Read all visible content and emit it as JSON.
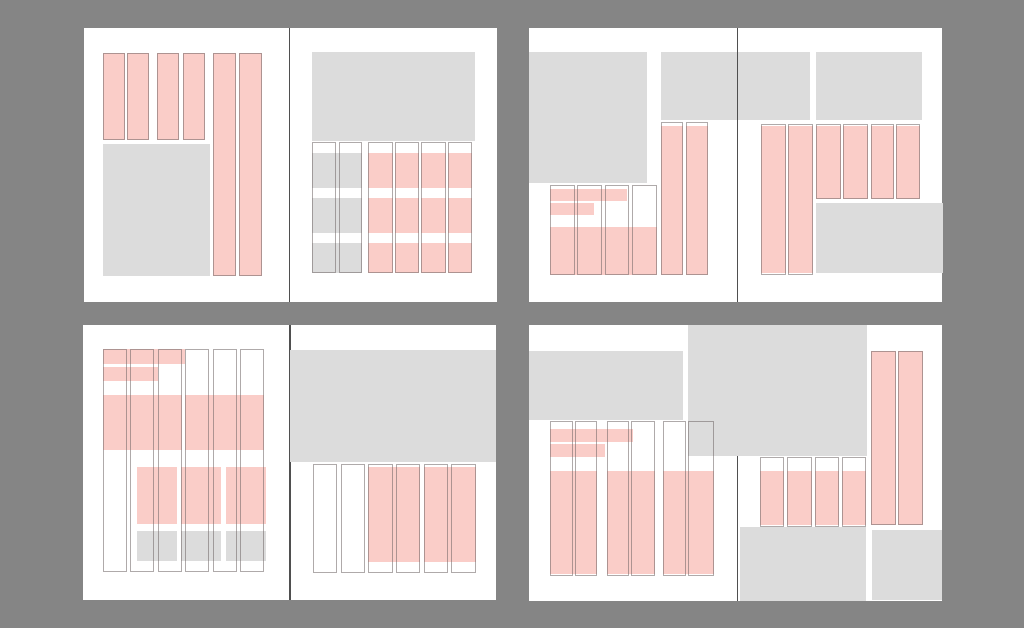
{
  "canvas": {
    "width": 1024,
    "height": 628,
    "background": "#858585"
  },
  "colors": {
    "page_white": "#ffffff",
    "block_gray": "#dcdcdc",
    "block_pink": "#facdc8",
    "outline": "rgba(110,100,100,0.55)",
    "spine": "#4f4f4f"
  },
  "legend": {
    "gray_block_meaning": "image-placeholder-block",
    "pink_block_meaning": "text-content-block",
    "outline_meaning": "column-outline"
  },
  "spreads": [
    {
      "name": "spread-top-left",
      "x": 84,
      "y": 28,
      "w": 412.5,
      "h": 273.5,
      "spine_x": 288.8,
      "spine_over": true,
      "blocks": [
        [
          "g",
          102.5,
          143.5,
          107.5,
          132.5
        ],
        [
          "g",
          312.3,
          52.0,
          162.5,
          89.0
        ],
        [
          "g",
          312.3,
          153.3,
          50.0,
          35.0
        ],
        [
          "g",
          312.3,
          198.3,
          50.0,
          35.0
        ],
        [
          "g",
          312.3,
          243.3,
          50.0,
          30.0
        ],
        [
          "p",
          102.5,
          52.7,
          22.0,
          87.0
        ],
        [
          "p",
          127.0,
          52.7,
          22.0,
          87.0
        ],
        [
          "p",
          156.5,
          52.7,
          22.0,
          87.0
        ],
        [
          "p",
          183.0,
          52.7,
          22.0,
          87.0
        ],
        [
          "p",
          213.0,
          52.7,
          23.0,
          223.3
        ],
        [
          "p",
          239.0,
          52.7,
          23.0,
          223.3
        ],
        [
          "p",
          368.3,
          153.3,
          24.5,
          35.0
        ],
        [
          "p",
          394.8,
          153.3,
          24.5,
          35.0
        ],
        [
          "p",
          421.3,
          153.3,
          24.5,
          35.0
        ],
        [
          "p",
          447.8,
          153.3,
          24.5,
          35.0
        ],
        [
          "p",
          368.3,
          198.3,
          24.5,
          35.0
        ],
        [
          "p",
          394.8,
          198.3,
          24.5,
          35.0
        ],
        [
          "p",
          421.3,
          198.3,
          24.5,
          35.0
        ],
        [
          "p",
          447.8,
          198.3,
          24.5,
          35.0
        ],
        [
          "p",
          368.3,
          243.3,
          24.5,
          30.0
        ],
        [
          "p",
          394.8,
          243.3,
          24.5,
          30.0
        ],
        [
          "p",
          421.3,
          243.3,
          24.5,
          30.0
        ],
        [
          "p",
          447.8,
          243.3,
          24.5,
          30.0
        ],
        [
          "o",
          102.5,
          52.7,
          22.0,
          87.0
        ],
        [
          "o",
          127.0,
          52.7,
          22.0,
          87.0
        ],
        [
          "o",
          156.5,
          52.7,
          22.0,
          87.0
        ],
        [
          "o",
          183.0,
          52.7,
          22.0,
          87.0
        ],
        [
          "o",
          213.0,
          52.7,
          23.0,
          223.3
        ],
        [
          "o",
          239.0,
          52.7,
          23.0,
          223.3
        ],
        [
          "o",
          312.3,
          142.3,
          23.7,
          131.0
        ],
        [
          "o",
          338.6,
          142.3,
          23.7,
          131.0
        ],
        [
          "o",
          368.3,
          142.3,
          24.5,
          131.0
        ],
        [
          "o",
          394.8,
          142.3,
          24.5,
          131.0
        ],
        [
          "o",
          421.3,
          142.3,
          24.5,
          131.0
        ],
        [
          "o",
          447.8,
          142.3,
          24.5,
          131.0
        ]
      ]
    },
    {
      "name": "spread-top-right",
      "x": 529,
      "y": 28,
      "w": 412.7,
      "h": 273.5,
      "spine_x": 736.8,
      "spine_over": true,
      "blocks": [
        [
          "g",
          529.0,
          52.3,
          118.0,
          131.0
        ],
        [
          "g",
          660.7,
          52.3,
          149.3,
          68.0
        ],
        [
          "g",
          816.0,
          52.3,
          105.7,
          67.7
        ],
        [
          "g",
          816.0,
          203.3,
          126.5,
          70.0
        ],
        [
          "p",
          550.0,
          189.0,
          77.0,
          12.3
        ],
        [
          "p",
          550.0,
          203.0,
          44.0,
          12.3
        ],
        [
          "p",
          550.0,
          226.7,
          106.7,
          48.3
        ],
        [
          "p",
          661.0,
          126.0,
          22.0,
          149.0
        ],
        [
          "p",
          685.5,
          126.0,
          22.8,
          149.0
        ],
        [
          "p",
          760.7,
          126.0,
          25.0,
          147.3
        ],
        [
          "p",
          788.0,
          126.0,
          24.7,
          147.3
        ],
        [
          "p",
          816.0,
          125.5,
          24.7,
          73.0
        ],
        [
          "p",
          843.3,
          125.5,
          25.0,
          73.0
        ],
        [
          "p",
          870.7,
          125.5,
          23.3,
          73.0
        ],
        [
          "p",
          896.3,
          125.5,
          23.7,
          73.0
        ],
        [
          "o",
          550.0,
          184.7,
          24.6,
          90.3
        ],
        [
          "o",
          577.4,
          184.7,
          24.6,
          90.3
        ],
        [
          "o",
          604.8,
          184.7,
          24.6,
          90.3
        ],
        [
          "o",
          632.1,
          184.7,
          24.6,
          90.3
        ],
        [
          "o",
          661.0,
          121.7,
          22.0,
          153.3
        ],
        [
          "o",
          685.5,
          121.7,
          22.8,
          153.3
        ],
        [
          "o",
          760.7,
          123.5,
          25.0,
          151.5
        ],
        [
          "o",
          788.0,
          123.5,
          24.7,
          151.5
        ],
        [
          "o",
          816.0,
          124.0,
          24.7,
          74.5
        ],
        [
          "o",
          843.3,
          124.0,
          25.0,
          74.5
        ],
        [
          "o",
          870.7,
          124.0,
          23.3,
          74.5
        ],
        [
          "o",
          896.3,
          124.0,
          23.7,
          74.5
        ]
      ]
    },
    {
      "name": "spread-bottom-left",
      "x": 82.7,
      "y": 325.3,
      "w": 413.0,
      "h": 274.4,
      "spine_x": 289.5,
      "spine_over": false,
      "blocks": [
        [
          "g",
          290.2,
          349.7,
          205.5,
          112.3
        ],
        [
          "g",
          136.7,
          531.0,
          40.0,
          30.0
        ],
        [
          "g",
          181.0,
          531.0,
          40.0,
          30.0
        ],
        [
          "g",
          226.0,
          531.0,
          40.0,
          30.0
        ],
        [
          "p",
          103.0,
          349.5,
          82.0,
          14.5
        ],
        [
          "p",
          103.0,
          366.7,
          55.3,
          14.0
        ],
        [
          "p",
          103.0,
          395.0,
          78.8,
          55.0
        ],
        [
          "p",
          185.2,
          395.0,
          78.8,
          55.0
        ],
        [
          "p",
          136.7,
          466.7,
          40.0,
          57.3
        ],
        [
          "p",
          181.0,
          466.7,
          40.0,
          57.3
        ],
        [
          "p",
          226.0,
          466.7,
          40.0,
          57.3
        ],
        [
          "p",
          368.4,
          466.7,
          52.0,
          95.0
        ],
        [
          "p",
          423.8,
          466.7,
          52.0,
          95.0
        ],
        [
          "o",
          103.0,
          349.3,
          24.0,
          222.4
        ],
        [
          "o",
          130.4,
          349.3,
          24.0,
          222.4
        ],
        [
          "o",
          157.8,
          349.3,
          24.0,
          222.4
        ],
        [
          "o",
          185.2,
          349.3,
          24.0,
          222.4
        ],
        [
          "o",
          212.6,
          349.3,
          24.0,
          222.4
        ],
        [
          "o",
          240.0,
          349.3,
          24.0,
          222.4
        ],
        [
          "o",
          313.0,
          464.0,
          24.3,
          109.0
        ],
        [
          "o",
          340.7,
          464.0,
          24.3,
          109.0
        ],
        [
          "o",
          368.4,
          464.0,
          24.3,
          109.0
        ],
        [
          "o",
          396.1,
          464.0,
          24.3,
          109.0
        ],
        [
          "o",
          423.8,
          464.0,
          24.3,
          109.0
        ],
        [
          "o",
          451.5,
          464.0,
          24.3,
          109.0
        ]
      ]
    },
    {
      "name": "spread-bottom-right",
      "x": 529,
      "y": 324.7,
      "w": 412.7,
      "h": 276.8,
      "spine_x": 736.8,
      "spine_over": false,
      "blocks": [
        [
          "g",
          529.0,
          351.3,
          154.0,
          68.4
        ],
        [
          "g",
          688.3,
          324.7,
          178.4,
          131.6
        ],
        [
          "g",
          739.5,
          527.3,
          126.0,
          74.0
        ],
        [
          "g",
          871.7,
          529.7,
          70.0,
          70.0
        ],
        [
          "p",
          550.0,
          429.3,
          83.3,
          12.4
        ],
        [
          "p",
          550.0,
          444.0,
          55.0,
          13.3
        ],
        [
          "p",
          550.0,
          470.7,
          47.0,
          103.3
        ],
        [
          "p",
          606.5,
          470.7,
          48.5,
          103.3
        ],
        [
          "p",
          662.5,
          470.7,
          51.8,
          103.3
        ],
        [
          "p",
          760.0,
          471.0,
          24.4,
          54.0
        ],
        [
          "p",
          787.3,
          471.0,
          24.4,
          54.0
        ],
        [
          "p",
          814.6,
          471.0,
          24.4,
          54.0
        ],
        [
          "p",
          841.9,
          471.0,
          24.4,
          54.0
        ],
        [
          "p",
          871.0,
          351.3,
          24.5,
          173.4
        ],
        [
          "p",
          898.0,
          351.3,
          24.5,
          173.4
        ],
        [
          "o",
          550.0,
          421.0,
          22.5,
          155.0
        ],
        [
          "o",
          574.8,
          421.0,
          22.2,
          155.0
        ],
        [
          "o",
          606.5,
          421.0,
          22.5,
          155.0
        ],
        [
          "o",
          631.3,
          421.0,
          23.7,
          155.0
        ],
        [
          "o",
          662.5,
          421.0,
          23.0,
          155.0
        ],
        [
          "o",
          688.0,
          421.0,
          26.3,
          155.0
        ],
        [
          "o",
          760.0,
          457.0,
          24.4,
          70.0
        ],
        [
          "o",
          787.3,
          457.0,
          24.4,
          70.0
        ],
        [
          "o",
          814.6,
          457.0,
          24.4,
          70.0
        ],
        [
          "o",
          841.9,
          457.0,
          24.4,
          70.0
        ],
        [
          "o",
          871.0,
          350.7,
          24.5,
          174.5
        ],
        [
          "o",
          898.0,
          350.7,
          24.5,
          174.5
        ]
      ]
    }
  ]
}
